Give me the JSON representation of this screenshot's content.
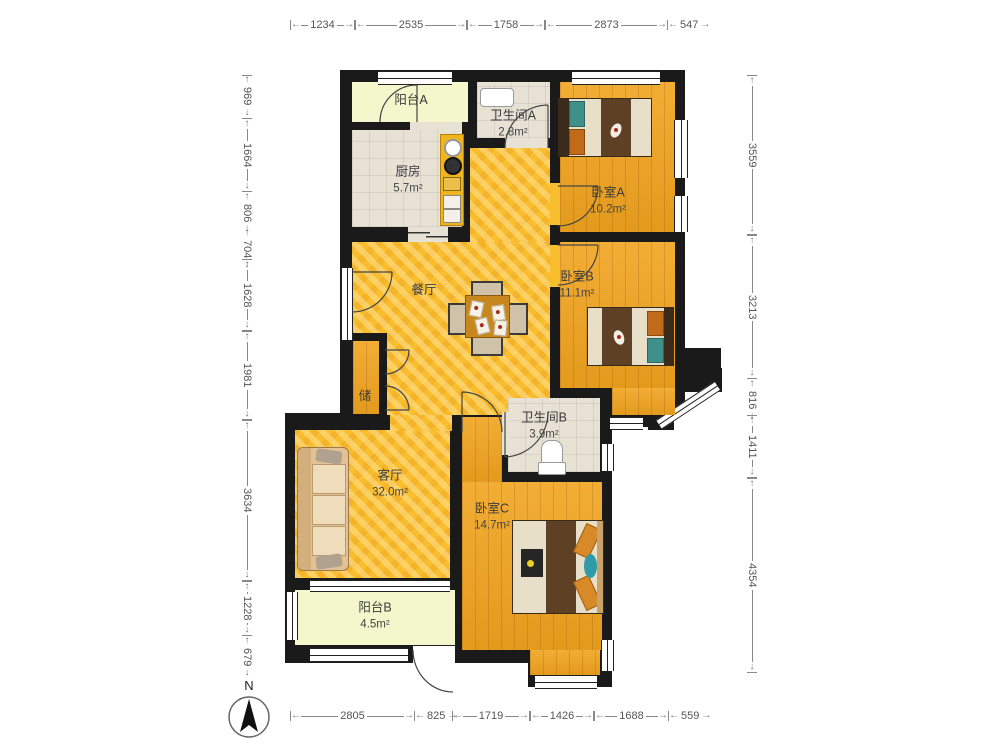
{
  "compass": {
    "label": "N"
  },
  "rooms": {
    "balcony_a": {
      "name": "阳台A",
      "area": ""
    },
    "kitchen": {
      "name": "厨房",
      "area": "5.7m²"
    },
    "bath_a": {
      "name": "卫生间A",
      "area": "2.8m²"
    },
    "bed_a": {
      "name": "卧室A",
      "area": "10.2m²"
    },
    "bed_b": {
      "name": "卧室B",
      "area": "11.1m²"
    },
    "dining": {
      "name": "餐厅",
      "area": ""
    },
    "storage": {
      "name": "储",
      "area": ""
    },
    "living": {
      "name": "客厅",
      "area": "32.0m²"
    },
    "bath_b": {
      "name": "卫生间B",
      "area": "3.9m²"
    },
    "bed_c": {
      "name": "卧室C",
      "area": "14.7m²"
    },
    "balcony_b": {
      "name": "阳台B",
      "area": "4.5m²"
    }
  },
  "dimensions": {
    "top": [
      {
        "label": "1234",
        "from": 290,
        "to": 355
      },
      {
        "label": "2535",
        "from": 355,
        "to": 467
      },
      {
        "label": "1758",
        "from": 467,
        "to": 545
      },
      {
        "label": "2873",
        "from": 545,
        "to": 668
      },
      {
        "label": "547",
        "from": 668,
        "to": 693
      }
    ],
    "bottom": [
      {
        "label": "2805",
        "from": 290,
        "to": 415
      },
      {
        "label": "825",
        "from": 415,
        "to": 452
      },
      {
        "label": "1719",
        "from": 452,
        "to": 530
      },
      {
        "label": "1426",
        "from": 530,
        "to": 594
      },
      {
        "label": "1688",
        "from": 594,
        "to": 669
      },
      {
        "label": "559",
        "from": 669,
        "to": 694
      }
    ],
    "left": [
      {
        "label": "969",
        "from": 75,
        "to": 118
      },
      {
        "label": "1664",
        "from": 118,
        "to": 192
      },
      {
        "label": "806",
        "from": 192,
        "to": 228
      },
      {
        "label": "704",
        "from": 228,
        "to": 259
      },
      {
        "label": "1628",
        "from": 259,
        "to": 331
      },
      {
        "label": "1981",
        "from": 331,
        "to": 420
      },
      {
        "label": "3634",
        "from": 420,
        "to": 581
      },
      {
        "label": "1228",
        "from": 581,
        "to": 636
      },
      {
        "label": "679",
        "from": 636,
        "to": 666
      }
    ],
    "right": [
      {
        "label": "3559",
        "from": 75,
        "to": 235
      },
      {
        "label": "3213",
        "from": 235,
        "to": 379
      },
      {
        "label": "816",
        "from": 379,
        "to": 415
      },
      {
        "label": "1411",
        "from": 415,
        "to": 478
      },
      {
        "label": "4354",
        "from": 478,
        "to": 673
      }
    ]
  },
  "axes": {
    "top_y": 25,
    "bottom_y": 716,
    "left_x": 247,
    "right_x": 752
  }
}
